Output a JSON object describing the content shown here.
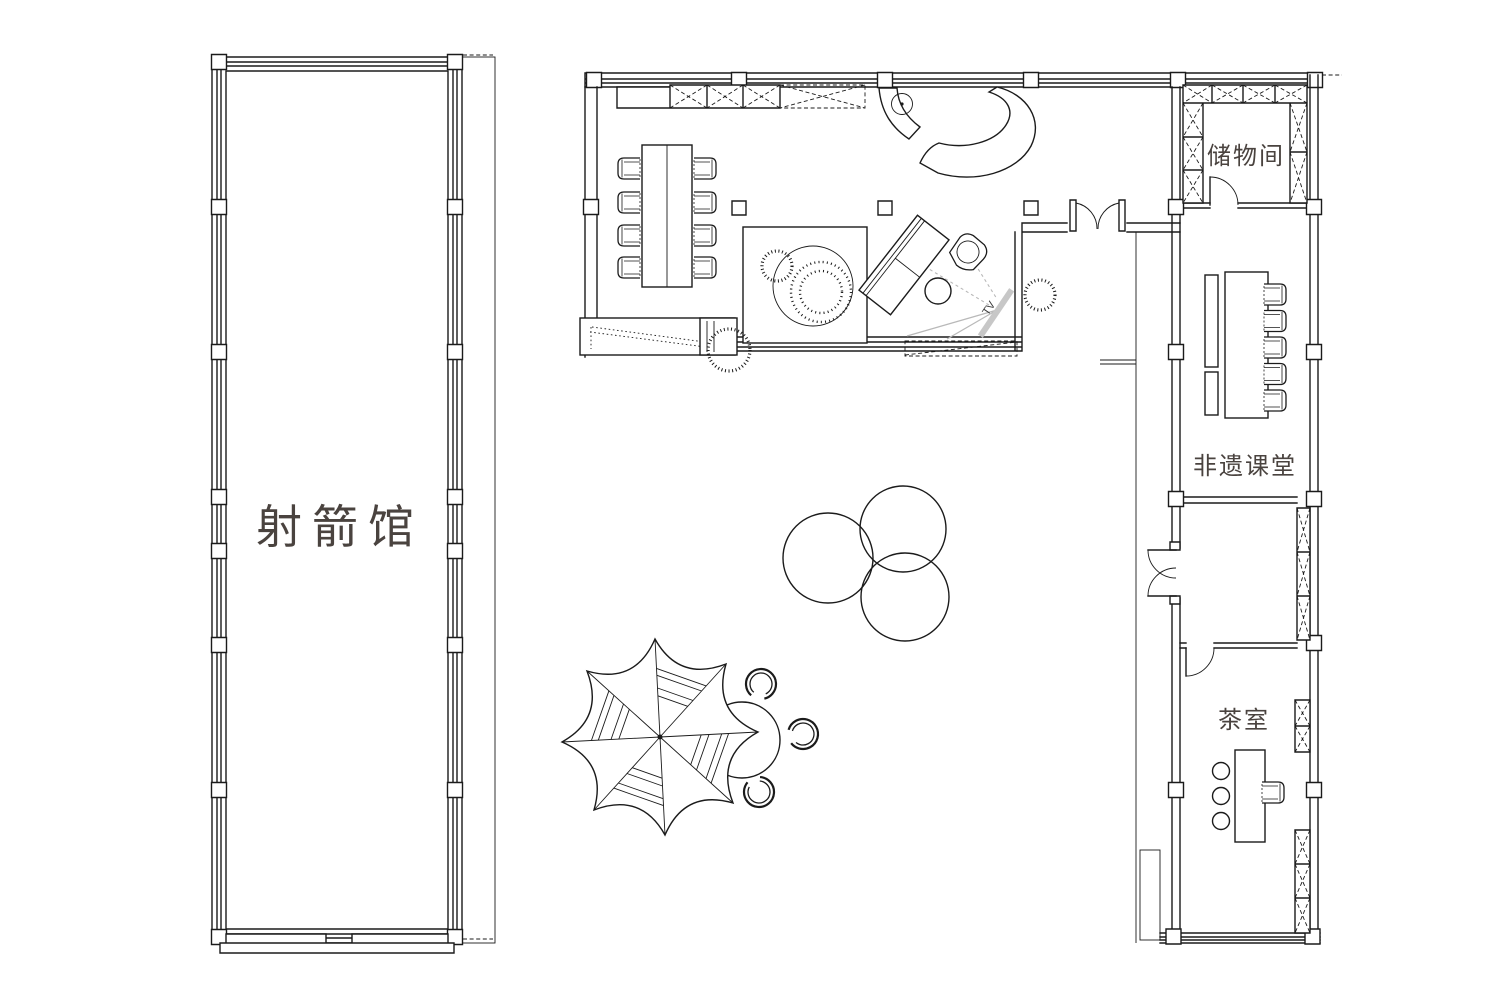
{
  "canvas": {
    "width_px": 1500,
    "height_px": 1004,
    "background": "#ffffff"
  },
  "palette": {
    "line": "#1b1b1b",
    "room_label": "#4a433f",
    "tv_fill": "#c7c7c7",
    "sightline_gray": "#b9b9b9"
  },
  "rooms": [
    {
      "id": "archery-hall",
      "label": "射箭馆"
    },
    {
      "id": "storage-room",
      "label": "储物间"
    },
    {
      "id": "heritage-classroom",
      "label": "非遗课堂"
    },
    {
      "id": "tea-room",
      "label": "茶室"
    }
  ],
  "annotations": {
    "tv_label": "TV"
  }
}
